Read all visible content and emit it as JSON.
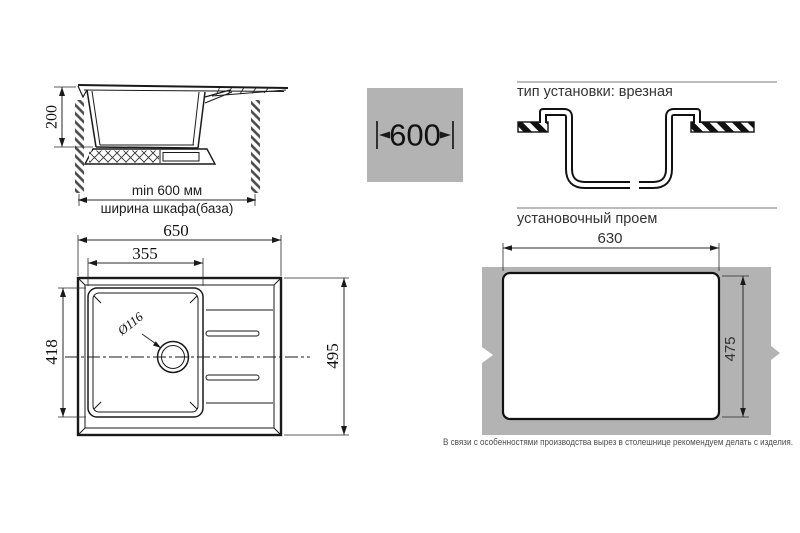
{
  "drawing": {
    "cabinet_section": {
      "height_dim": "200",
      "min_width_dim": "min 600 мм",
      "cabinet_label": "ширина шкафа(база)"
    },
    "cabinet_width_badge": {
      "value": "600"
    },
    "installation_type": {
      "header": "тип установки: врезная"
    },
    "top_view": {
      "overall_width": "650",
      "bowl_width": "355",
      "bowl_depth": "418",
      "overall_depth": "495",
      "drain_diameter": "Ø116"
    },
    "cutout": {
      "header": "установочный проем",
      "width": "630",
      "height": "475",
      "note": "В связи с особенностями производства вырез в столешнице рекомендуем делать с изделия."
    },
    "colors": {
      "gray_fill": "#b3b3b3",
      "line": "#1a1a1a"
    }
  }
}
